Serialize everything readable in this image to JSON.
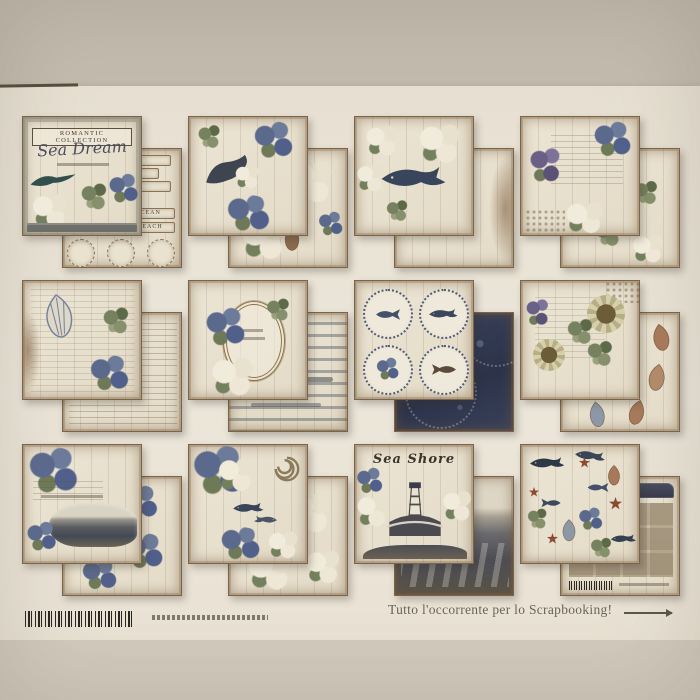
{
  "scene": {
    "type": "photograph",
    "subject": "Catalog sheet showing twelve vintage nautical scrapbook paper pads arranged in a 4x3 grid on a beige surface",
    "surface_color": "#c3bbae",
    "sheet_color": "#ebe5d8",
    "bottom_surface_color": "#d2cabd"
  },
  "cover": {
    "collection": "ROMANTIC COLLECTION",
    "title": "Sea Dream"
  },
  "tags": {
    "ocean": "OCEAN",
    "beach": "BEACH"
  },
  "titles": {
    "sea_shore": "Sea Shore"
  },
  "packs": [
    {
      "id": 1,
      "front": "Sea Dream paper pad cover with Romantic Collection label, dark bird and floral collage",
      "back": "die-cut labels sheet with word strips, OCEAN and BEACH tags and round medallions"
    },
    {
      "id": 2,
      "front": "seal with blue peonies collage on white wood planks",
      "back": "white and blue flowers with conch shell on planks"
    },
    {
      "id": 3,
      "front": "humpback whale inside white flower wreath on planks",
      "back": "plain weathered white wood planks"
    },
    {
      "id": 4,
      "front": "handwritten script with purple wisteria, lace and pale blue ribbon",
      "back": "scattered flower sprigs on white planks"
    },
    {
      "id": 5,
      "front": "large seashell sketch over vintage script and flowers",
      "back": "aged handwriting and newsprint collage"
    },
    {
      "id": 6,
      "front": "ornate oval frame wreathed with blue and white flowers",
      "back": "distressed grey stripe planks"
    },
    {
      "id": 7,
      "front": "four dotted circle medallions with sea life sketches",
      "back": "dark navy lace and starry night texture"
    },
    {
      "id": 8,
      "front": "sunflowers and script on weathered planks",
      "back": "brown and blue conch shell pattern"
    },
    {
      "id": 9,
      "front": "blue roses, script lettering and coastal inlet scene",
      "back": "blue thistle flowers on white planks"
    },
    {
      "id": 10,
      "front": "blue peonies, nautilus shell and whale silhouettes",
      "back": "white magnolia flowers on planks"
    },
    {
      "id": 11,
      "front": "Sea Shore lettering with lighthouse and rocky coast",
      "back": "dark stormy sea waves on planks"
    },
    {
      "id": 12,
      "front": "sea animals pattern with whales, sharks, starfish and shells",
      "back": "paper pad back cover with thumbnail grid and barcode"
    }
  ],
  "footer": {
    "tagline": "Tutto l'occorrente per lo Scrapbooking!",
    "barcode": "product barcode",
    "fine_print": "illegible small print line"
  }
}
